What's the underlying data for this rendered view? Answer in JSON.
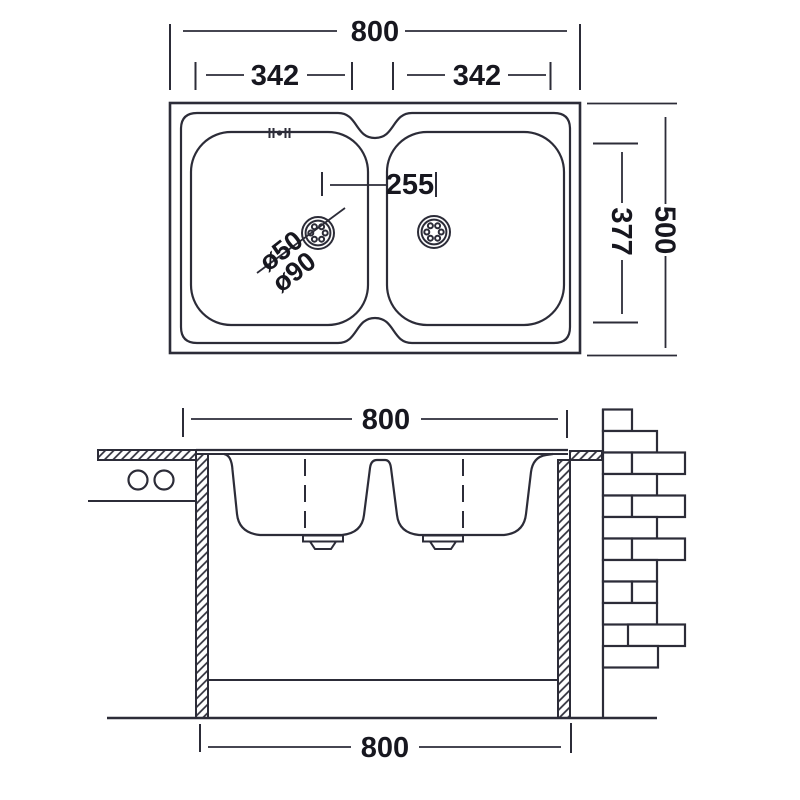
{
  "colors": {
    "background": "#ffffff",
    "line": "#2c2c38",
    "text": "#17171f"
  },
  "top_view": {
    "label_overall_width": "800",
    "label_left_bowl_width": "342",
    "label_right_bowl_width": "342",
    "label_drain_offset": "255",
    "label_drain_hole_diameter": "ø50",
    "label_drain_flange_diameter": "ø90",
    "label_overall_depth": "500",
    "label_bowl_depth": "377"
  },
  "front_view": {
    "label_overall_width": "800",
    "label_base_width": "800"
  }
}
